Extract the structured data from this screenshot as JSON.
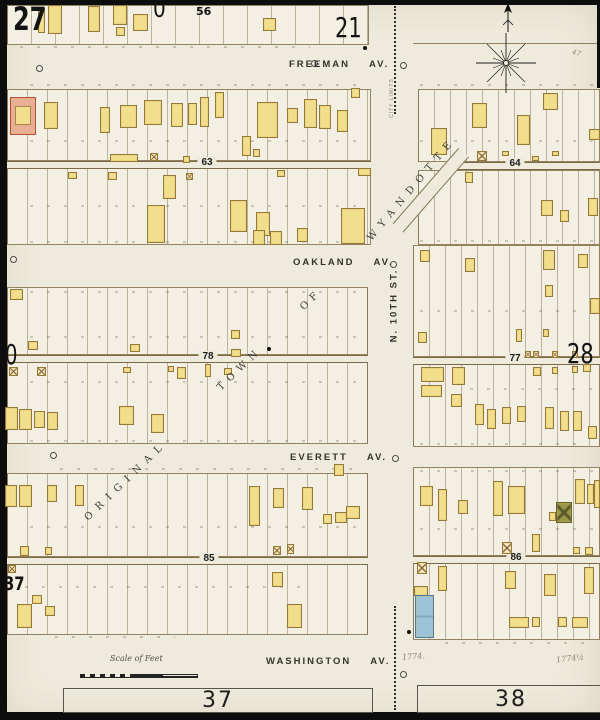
{
  "page": {
    "sheet_tl": "27",
    "zero_top": "0",
    "block_56": "56",
    "adjacent_top": "21",
    "adjacent_right": "28",
    "adjacent_left": "0",
    "adjacent_left_lower": "37",
    "bottom_sheet_left": "37",
    "bottom_sheet_right": "38"
  },
  "streets": {
    "freeman": {
      "name": "FREEMAN",
      "suffix": "AV."
    },
    "oakland": {
      "name": "OAKLAND",
      "suffix": "AV."
    },
    "everett": {
      "name": "EVERETT",
      "suffix": "AV."
    },
    "washington": {
      "name": "WASHINGTON",
      "suffix": "AV."
    },
    "n10th": "N. 10TH ST."
  },
  "plat": {
    "word1": "ORIGINAL",
    "word2": "TOWN",
    "word3": "OF",
    "word4": "WYANDOTTE"
  },
  "annotations": {
    "scale_label": "Scale of Feet",
    "city_limits": "CITY LIMITS",
    "pencil_a": "1774.",
    "pencil_b": "1774½",
    "pencil_c": "47"
  },
  "map": {
    "colors": {
      "paper": "#efebdc",
      "block_fill": "#f3efe2",
      "building_fill": "#f2df8d",
      "building_stroke": "#94793c",
      "brick": "#e8af97",
      "stone": "#9cc3d8",
      "green_special": "#9a9a4a",
      "ink": "#1c1c1c",
      "lot_line": "#8a7850"
    },
    "borders": [
      [
        0,
        0,
        7,
        720
      ],
      [
        0,
        0,
        600,
        5
      ],
      [
        0,
        712,
        600,
        8
      ],
      [
        597,
        0,
        3,
        88
      ]
    ],
    "blocks": [
      [
        7,
        5,
        362,
        40,
        24
      ],
      [
        7,
        89,
        364,
        72,
        20
      ],
      [
        7,
        168,
        364,
        77,
        20
      ],
      [
        7,
        287,
        361,
        68,
        20
      ],
      [
        7,
        362,
        361,
        82,
        20
      ],
      [
        7,
        473,
        361,
        84,
        20
      ],
      [
        7,
        564,
        361,
        71,
        20
      ],
      [
        418,
        89,
        182,
        73,
        16
      ],
      [
        418,
        170,
        182,
        75,
        16
      ],
      [
        413,
        245,
        187,
        112,
        16
      ],
      [
        413,
        364,
        187,
        83,
        16
      ],
      [
        413,
        467,
        187,
        89,
        16
      ],
      [
        413,
        563,
        187,
        77,
        16
      ]
    ],
    "lines": [
      [
        413,
        43,
        184
      ]
    ],
    "alleys": [
      {
        "x": 7,
        "y": 161,
        "w": 364,
        "label": "63",
        "lx": 207
      },
      {
        "x": 455,
        "y": 162,
        "w": 145,
        "label": "64",
        "lx": 515
      },
      {
        "x": 7,
        "y": 355,
        "w": 361,
        "label": "78",
        "lx": 208
      },
      {
        "x": 413,
        "y": 357,
        "w": 187,
        "label": "77",
        "lx": 515
      },
      {
        "x": 7,
        "y": 557,
        "w": 361,
        "label": "85",
        "lx": 209
      },
      {
        "x": 413,
        "y": 556,
        "w": 187,
        "label": "86",
        "lx": 516
      }
    ],
    "diagonal_street": {
      "x": 398,
      "y": 221,
      "len": 100,
      "angle": -49
    },
    "strips": [
      [
        20,
        46,
        290
      ],
      [
        30,
        84,
        330
      ],
      [
        30,
        140,
        330
      ],
      [
        30,
        205,
        330
      ],
      [
        30,
        241,
        330
      ],
      [
        420,
        84,
        175
      ],
      [
        420,
        140,
        175
      ],
      [
        420,
        240,
        175
      ],
      [
        30,
        291,
        330
      ],
      [
        30,
        336,
        330
      ],
      [
        30,
        381,
        330
      ],
      [
        30,
        440,
        330
      ],
      [
        420,
        310,
        175
      ],
      [
        470,
        388,
        125
      ],
      [
        420,
        443,
        170
      ],
      [
        60,
        468,
        300
      ],
      [
        30,
        526,
        330
      ],
      [
        25,
        586,
        280
      ],
      [
        55,
        636,
        120
      ],
      [
        420,
        470,
        175
      ],
      [
        420,
        528,
        175
      ],
      [
        445,
        642,
        150
      ]
    ],
    "buildings": [
      [
        38,
        8,
        7,
        25
      ],
      [
        48,
        5,
        14,
        29
      ],
      [
        88,
        6,
        12,
        26
      ],
      [
        113,
        5,
        14,
        20
      ],
      [
        116,
        27,
        9,
        9
      ],
      [
        133,
        14,
        15,
        17
      ],
      [
        263,
        18,
        13,
        13
      ],
      [
        44,
        102,
        14,
        27
      ],
      [
        100,
        107,
        10,
        26
      ],
      [
        120,
        105,
        17,
        23
      ],
      [
        144,
        100,
        18,
        25
      ],
      [
        171,
        103,
        12,
        24
      ],
      [
        188,
        103,
        9,
        22
      ],
      [
        200,
        97,
        9,
        30
      ],
      [
        215,
        92,
        9,
        26
      ],
      [
        257,
        102,
        21,
        36
      ],
      [
        287,
        108,
        11,
        15
      ],
      [
        304,
        99,
        13,
        29
      ],
      [
        319,
        105,
        12,
        24
      ],
      [
        337,
        110,
        11,
        22
      ],
      [
        351,
        88,
        9,
        10
      ],
      [
        110,
        154,
        28,
        8
      ],
      [
        183,
        156,
        7,
        7
      ],
      [
        242,
        136,
        9,
        20
      ],
      [
        253,
        149,
        7,
        8
      ],
      [
        68,
        172,
        9,
        7
      ],
      [
        108,
        172,
        9,
        8
      ],
      [
        277,
        170,
        8,
        7
      ],
      [
        358,
        168,
        13,
        8
      ],
      [
        163,
        175,
        13,
        24
      ],
      [
        147,
        205,
        18,
        38
      ],
      [
        230,
        200,
        17,
        32
      ],
      [
        256,
        212,
        14,
        24
      ],
      [
        297,
        228,
        11,
        14
      ],
      [
        341,
        208,
        24,
        36
      ],
      [
        253,
        230,
        12,
        15
      ],
      [
        270,
        231,
        12,
        14
      ],
      [
        10,
        289,
        13,
        11
      ],
      [
        28,
        341,
        10,
        9
      ],
      [
        130,
        344,
        10,
        8
      ],
      [
        231,
        330,
        9,
        9
      ],
      [
        231,
        349,
        10,
        8
      ],
      [
        123,
        367,
        8,
        6
      ],
      [
        168,
        366,
        6,
        6
      ],
      [
        177,
        367,
        9,
        12
      ],
      [
        205,
        364,
        6,
        13
      ],
      [
        224,
        368,
        8,
        7
      ],
      [
        5,
        407,
        13,
        23
      ],
      [
        19,
        409,
        13,
        21
      ],
      [
        34,
        411,
        11,
        17
      ],
      [
        47,
        412,
        11,
        18
      ],
      [
        119,
        406,
        15,
        19
      ],
      [
        151,
        414,
        13,
        19
      ],
      [
        5,
        485,
        12,
        22
      ],
      [
        19,
        485,
        13,
        22
      ],
      [
        47,
        485,
        10,
        17
      ],
      [
        75,
        485,
        9,
        21
      ],
      [
        20,
        546,
        9,
        10
      ],
      [
        45,
        547,
        7,
        8
      ],
      [
        249,
        486,
        11,
        40
      ],
      [
        273,
        488,
        11,
        20
      ],
      [
        302,
        487,
        11,
        23
      ],
      [
        323,
        514,
        9,
        10
      ],
      [
        335,
        512,
        12,
        11
      ],
      [
        346,
        506,
        14,
        13
      ],
      [
        334,
        464,
        10,
        12
      ],
      [
        17,
        604,
        15,
        24
      ],
      [
        32,
        595,
        10,
        9
      ],
      [
        45,
        606,
        10,
        10
      ],
      [
        272,
        572,
        11,
        15
      ],
      [
        287,
        604,
        15,
        24
      ],
      [
        431,
        128,
        16,
        27
      ],
      [
        472,
        103,
        15,
        25
      ],
      [
        517,
        115,
        13,
        30
      ],
      [
        543,
        93,
        15,
        17
      ],
      [
        589,
        129,
        11,
        11
      ],
      [
        502,
        151,
        7,
        5
      ],
      [
        532,
        156,
        7,
        5
      ],
      [
        552,
        151,
        7,
        5
      ],
      [
        465,
        172,
        8,
        11
      ],
      [
        541,
        200,
        12,
        16
      ],
      [
        560,
        210,
        9,
        12
      ],
      [
        588,
        198,
        10,
        18
      ],
      [
        420,
        250,
        10,
        12
      ],
      [
        465,
        258,
        10,
        14
      ],
      [
        543,
        250,
        12,
        20
      ],
      [
        578,
        254,
        10,
        14
      ],
      [
        545,
        285,
        8,
        12
      ],
      [
        590,
        298,
        10,
        16
      ],
      [
        418,
        332,
        9,
        11
      ],
      [
        516,
        329,
        6,
        13
      ],
      [
        543,
        329,
        6,
        8
      ],
      [
        421,
        367,
        23,
        15
      ],
      [
        452,
        367,
        13,
        18
      ],
      [
        421,
        385,
        21,
        12
      ],
      [
        451,
        394,
        11,
        13
      ],
      [
        475,
        404,
        9,
        21
      ],
      [
        487,
        409,
        9,
        20
      ],
      [
        502,
        407,
        9,
        17
      ],
      [
        517,
        406,
        9,
        16
      ],
      [
        545,
        407,
        9,
        22
      ],
      [
        560,
        411,
        9,
        20
      ],
      [
        573,
        411,
        9,
        20
      ],
      [
        588,
        426,
        9,
        13
      ],
      [
        533,
        367,
        8,
        9
      ],
      [
        552,
        367,
        6,
        7
      ],
      [
        572,
        366,
        6,
        7
      ],
      [
        583,
        364,
        8,
        8
      ],
      [
        420,
        486,
        13,
        20
      ],
      [
        438,
        489,
        9,
        32
      ],
      [
        458,
        500,
        10,
        14
      ],
      [
        493,
        481,
        10,
        35
      ],
      [
        508,
        486,
        17,
        28
      ],
      [
        549,
        512,
        7,
        9
      ],
      [
        575,
        479,
        10,
        25
      ],
      [
        587,
        484,
        7,
        20
      ],
      [
        594,
        480,
        6,
        28
      ],
      [
        532,
        534,
        8,
        18
      ],
      [
        573,
        547,
        7,
        7
      ],
      [
        585,
        547,
        8,
        8
      ],
      [
        438,
        566,
        9,
        25
      ],
      [
        414,
        586,
        14,
        10
      ],
      [
        505,
        571,
        11,
        18
      ],
      [
        544,
        574,
        12,
        22
      ],
      [
        584,
        567,
        10,
        27
      ],
      [
        509,
        617,
        20,
        11
      ],
      [
        532,
        617,
        8,
        10
      ],
      [
        558,
        617,
        9,
        10
      ],
      [
        572,
        617,
        16,
        11
      ]
    ],
    "xsheds": [
      [
        150,
        153,
        8,
        8
      ],
      [
        186,
        173,
        7,
        7
      ],
      [
        9,
        367,
        9,
        9
      ],
      [
        37,
        367,
        9,
        9
      ],
      [
        8,
        565,
        8,
        8
      ],
      [
        273,
        546,
        8,
        9
      ],
      [
        287,
        544,
        7,
        10
      ],
      [
        477,
        151,
        10,
        10
      ],
      [
        525,
        351,
        6,
        7
      ],
      [
        533,
        351,
        6,
        7
      ],
      [
        552,
        351,
        6,
        7
      ],
      [
        572,
        351,
        6,
        7
      ],
      [
        502,
        542,
        10,
        12
      ],
      [
        417,
        562,
        10,
        12
      ]
    ],
    "specials": [
      [
        "brick",
        10,
        97,
        26,
        38
      ],
      [
        "stone",
        415,
        595,
        19,
        43
      ],
      [
        "green",
        556,
        502,
        16,
        21
      ]
    ],
    "dotted_segments": [
      [
        394,
        6,
        108
      ],
      [
        394,
        606,
        104
      ]
    ],
    "circles": [
      [
        36,
        65
      ],
      [
        311,
        60
      ],
      [
        400,
        62
      ],
      [
        390,
        261
      ],
      [
        392,
        455
      ],
      [
        50,
        452
      ],
      [
        400,
        671
      ],
      [
        10,
        256
      ]
    ],
    "dots": [
      [
        363,
        46
      ],
      [
        407,
        630
      ],
      [
        267,
        347
      ]
    ]
  }
}
